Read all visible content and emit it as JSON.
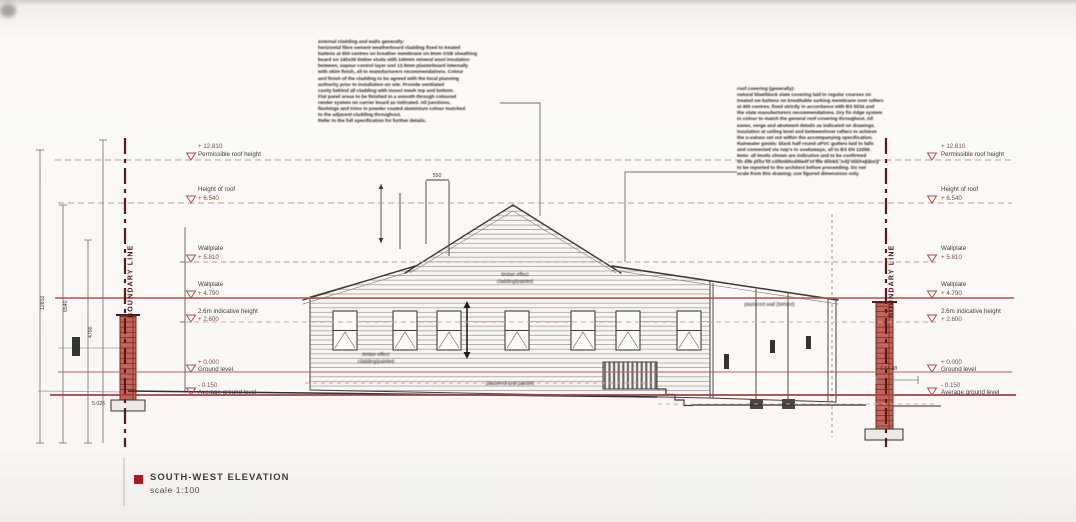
{
  "page": {
    "title_label": "SOUTH-WEST ELEVATION",
    "scale_label": "scale 1:100"
  },
  "boundary_label": "BOUNDARY LINE",
  "levels_left": [
    {
      "a": "+ 12.810",
      "b": "Permissible roof height"
    },
    {
      "a": "Height of roof",
      "b": "+ 6.540"
    },
    {
      "a": "Wallplate",
      "b": "+ 5.810"
    },
    {
      "a": "Wallplate",
      "b": "+ 4.790"
    },
    {
      "a": "2.6m indicative height",
      "b": "+ 2.600"
    },
    {
      "a": "+ 0.000",
      "b": "Ground level"
    },
    {
      "a": "- 0.150",
      "b": "Average ground level"
    }
  ],
  "levels_right": [
    {
      "a": "+ 12.810",
      "b": "Permissible roof height"
    },
    {
      "a": "Height of roof",
      "b": "+ 6.540"
    },
    {
      "a": "Wallplate",
      "b": "+ 5.810"
    },
    {
      "a": "Wallplate",
      "b": "+ 4.790"
    },
    {
      "a": "2.6m indicative height",
      "b": "+ 2.600"
    },
    {
      "a": "+ 0.000",
      "b": "Ground level"
    },
    {
      "a": "- 0.150",
      "b": "Average ground level"
    }
  ],
  "notes": {
    "gable": "timber effect\ncladding/painted",
    "wall": "timber effect\ncladding/painted",
    "base": "plastered and painted",
    "annex": "plastered wall (behind)"
  },
  "dims": {
    "gable_width": "550",
    "datum_left": "5.026",
    "grade_right": "1 64 38",
    "dim1": "12810",
    "dim2": "6540",
    "dim3": "4790"
  },
  "annotations": {
    "left": "external cladding and walls generally:\nhorizontal fibre cement weatherboard cladding fixed to treated\nbattens at 600 centres on breather membrane on 9mm OSB sheathing\nboard on 140x38 timber studs with 140mm mineral wool insulation\nbetween, vapour control layer and 12.5mm plasterboard internally\nwith skim finish, all to manufacturers recommendations. Colour\nand finish of the cladding to be agreed with the local planning\nauthority prior to installation on site. Provide ventilated\ncavity behind all cladding with insect mesh top and bottom.\nFlat panel areas to be finished in a smooth through coloured\nrender system on carrier board as indicated. All junctions,\nflashings and trims in powder coated aluminium colour matched\nto the adjacent cladding throughout.\nRefer to the full specification for further details.",
    "right": "roof covering (generally):\nnatural blue/black slate covering laid in regular courses on\ntreated sw battens on breathable sarking membrane over rafters\nat 400 centres, fixed strictly in accordance with BS 5534 and\nthe slate manufacturers recommendations. Dry fix ridge system\nin colour to match the general roof covering throughout. All\neaves, verge and abutment details as indicated on drawings.\nInsulation at ceiling level and between/over rafters to achieve\nthe u-values set out within the accompanying specification.\nRainwater goods: black half round uPVC gutters laid to falls\nand connected via rwp's to soakaways, all to BS EN 12056.\nNote: all levels shown are indicative and to be confirmed\non site prior to commencement of the works. Any discrepancy\nto be reported to the architect before proceeding. Do not\nscale from this drawing; use figured dimensions only."
  }
}
